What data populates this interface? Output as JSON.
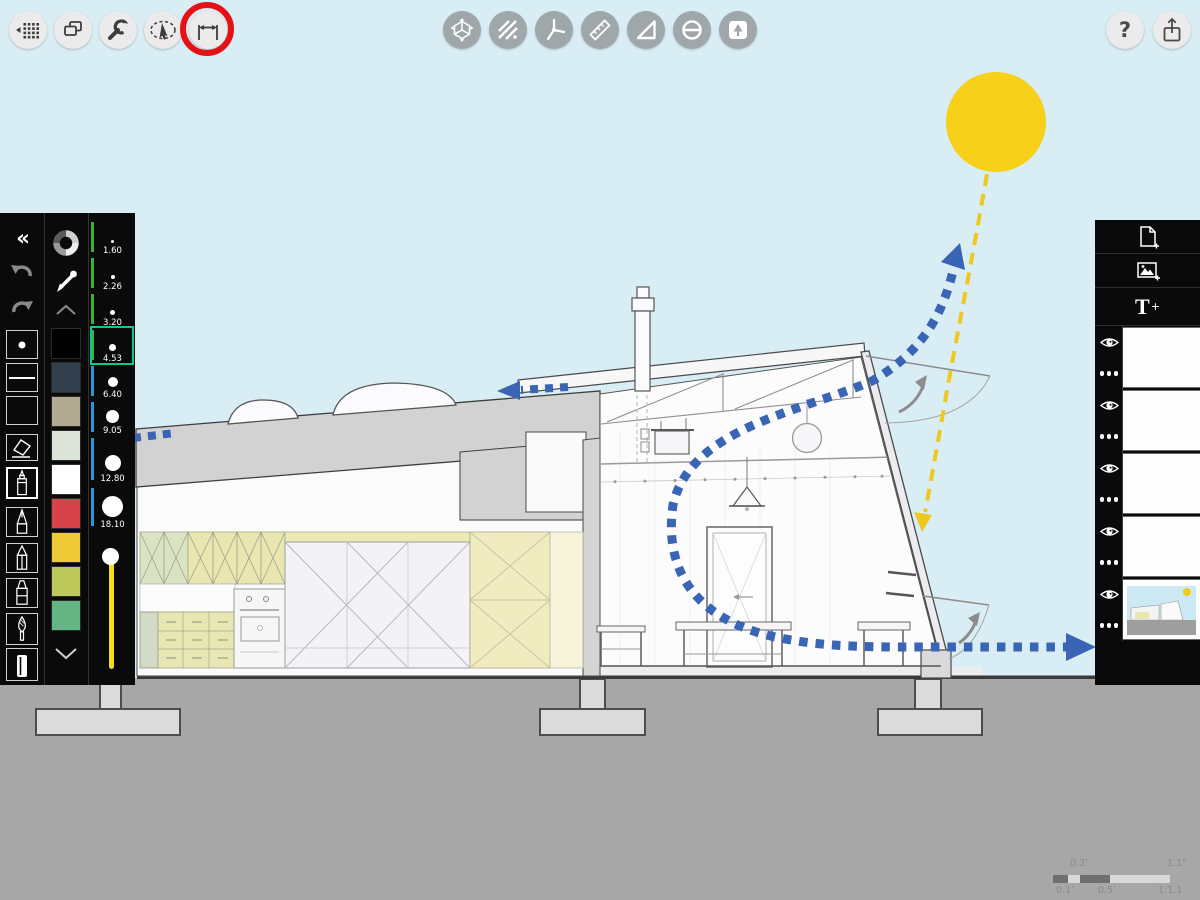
{
  "toolbar_left": {
    "items": [
      {
        "icon": "grid-pan-icon"
      },
      {
        "icon": "duplicate-icon"
      },
      {
        "icon": "wrench-settings-icon"
      },
      {
        "icon": "lasso-select-icon"
      },
      {
        "icon": "measure-tool-icon",
        "annotated": true
      }
    ]
  },
  "annotation": {
    "shape": "red-circle",
    "color": "#e41217",
    "target": "measure-tool"
  },
  "toolbar_center": {
    "items": [
      {
        "icon": "orbit-3d-icon"
      },
      {
        "icon": "hatch-fill-icon"
      },
      {
        "icon": "angle-lines-icon"
      },
      {
        "icon": "ruler-icon"
      },
      {
        "icon": "set-square-icon"
      },
      {
        "icon": "circle-diameter-icon"
      },
      {
        "icon": "stamp-tree-icon"
      }
    ]
  },
  "toolbar_right": {
    "help_label": "?",
    "items": [
      {
        "icon": "help-icon"
      },
      {
        "icon": "share-icon"
      }
    ]
  },
  "left_panel": {
    "collapse_label": "«",
    "tools": [
      "collapse-panel",
      "undo",
      "redo",
      "brush-tip-preview",
      "stroke-preview",
      "style-preview",
      "eraser",
      "fineliner-pen",
      "technical-pen",
      "pencil",
      "marker",
      "paintbrush",
      "paint-tube"
    ],
    "selected_tool": "fineliner-pen",
    "swatches": [
      "#000000",
      "#31404c",
      "#b2ab92",
      "#dce3d9",
      "#ffffff",
      "#d8434b",
      "#eeca38",
      "#bcc95a",
      "#65b584"
    ],
    "brush_sizes": [
      {
        "label": "1.60",
        "tick": "#36b43a",
        "selected": false
      },
      {
        "label": "2.26",
        "tick": "#36b43a",
        "selected": false
      },
      {
        "label": "3.20",
        "tick": "#36b43a",
        "selected": false
      },
      {
        "label": "4.53",
        "tick": "#36b43a",
        "selected": true
      },
      {
        "label": "6.40",
        "tick": "#1b9bd7",
        "selected": false
      },
      {
        "label": "9.05",
        "tick": "#1b9bd7",
        "selected": false
      },
      {
        "label": "12.80",
        "tick": "#1b9bd7",
        "selected": false
      },
      {
        "label": "18.10",
        "tick": "#1b9bd7",
        "selected": false
      }
    ],
    "selected_size_color": "#10c78f",
    "opacity_slider": {
      "track_color": "#f2e118",
      "knob_position": "top"
    }
  },
  "right_panel": {
    "buttons": [
      {
        "icon": "add-page-icon"
      },
      {
        "icon": "add-image-icon"
      },
      {
        "icon": "add-text-icon"
      }
    ],
    "text_label": "T",
    "text_plus": "+",
    "layers": [
      {
        "visible": true,
        "thumbnail": "blank"
      },
      {
        "visible": true,
        "thumbnail": "blank"
      },
      {
        "visible": true,
        "thumbnail": "blank"
      },
      {
        "visible": true,
        "thumbnail": "blank"
      },
      {
        "visible": true,
        "thumbnail": "section-drawing"
      }
    ]
  },
  "scale_widget": {
    "top_left": "0.3'",
    "top_right": "1.1\"",
    "bottom_left": "0.1'",
    "bottom_center": "0.5'",
    "bottom_right": "1:1.1"
  },
  "drawing": {
    "subject": "house-section-ventilation-diagram",
    "colors": {
      "sky": "#d9edf5",
      "ground": "#a7a7a7",
      "sun": "#f6d019",
      "sun_ray": "#eec81f",
      "airflow_blue": "#3a64b4",
      "roof_gray": "#d2d2d2",
      "cabinet_yellow": "#e9e6b2",
      "cabinet_green": "#dbe4c2",
      "swing_arrow_gray": "#8c8c8c"
    }
  }
}
